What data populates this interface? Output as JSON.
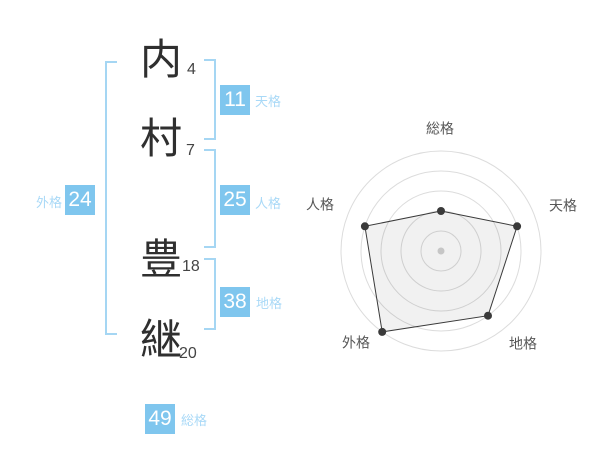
{
  "name": {
    "chars": [
      {
        "char": "内",
        "strokes": "4"
      },
      {
        "char": "村",
        "strokes": "7"
      },
      {
        "char": "豊",
        "strokes": "18"
      },
      {
        "char": "継",
        "strokes": "20"
      }
    ]
  },
  "scores": {
    "tenkaku": {
      "value": "11",
      "label": "天格"
    },
    "jinkaku": {
      "value": "25",
      "label": "人格"
    },
    "chikaku": {
      "value": "38",
      "label": "地格"
    },
    "gaikaku": {
      "value": "24",
      "label": "外格"
    },
    "soukaku": {
      "value": "49",
      "label": "総格"
    }
  },
  "colors": {
    "badge_blue": "#7fc6ee",
    "label_blue": "#a9d9f7",
    "bracket_blue": "#a5d6f3",
    "kanji_dark": "#2f2f2f",
    "ring_gray": "#dcdcdc",
    "polygon_stroke": "#3a3a3a",
    "polygon_fill": "rgba(0,0,0,0.055)",
    "center_dot": "#c6c6c6",
    "axis_label": "#575757"
  },
  "chart_data": {
    "type": "radar",
    "title": "",
    "axes": [
      "総格",
      "天格",
      "地格",
      "外格",
      "人格"
    ],
    "values": [
      2,
      4,
      4,
      5,
      4
    ],
    "max": 5,
    "rings": 5,
    "radius": 100,
    "center": [
      141,
      141
    ],
    "grid": "concentric-circles",
    "legend": "none"
  }
}
